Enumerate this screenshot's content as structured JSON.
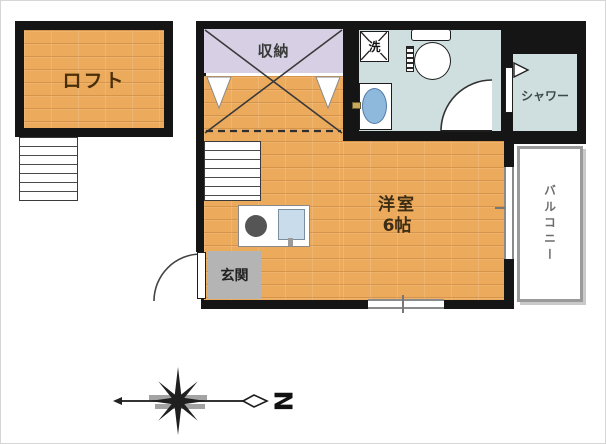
{
  "plan": {
    "loft_label": "ロフト",
    "storage_label": "収納",
    "washer_label": "洗",
    "shower_label": "シャワー",
    "room_label": "洋室",
    "room_size": "6帖",
    "entrance_label": "玄関",
    "balcony_label": "バルコニー",
    "compass_letter": "N"
  },
  "colors": {
    "wall": "#151515",
    "wood_floor": "#ecaa5c",
    "storage_floor": "#d7d0e5",
    "bath_floor": "#cfdfdf",
    "entrance_floor": "#b4b4b4",
    "basin_blue": "#8fb9dc",
    "sink_blue": "#c9dcec",
    "burner_gray": "#555555",
    "balcony_frame": "#9a9a9a"
  }
}
